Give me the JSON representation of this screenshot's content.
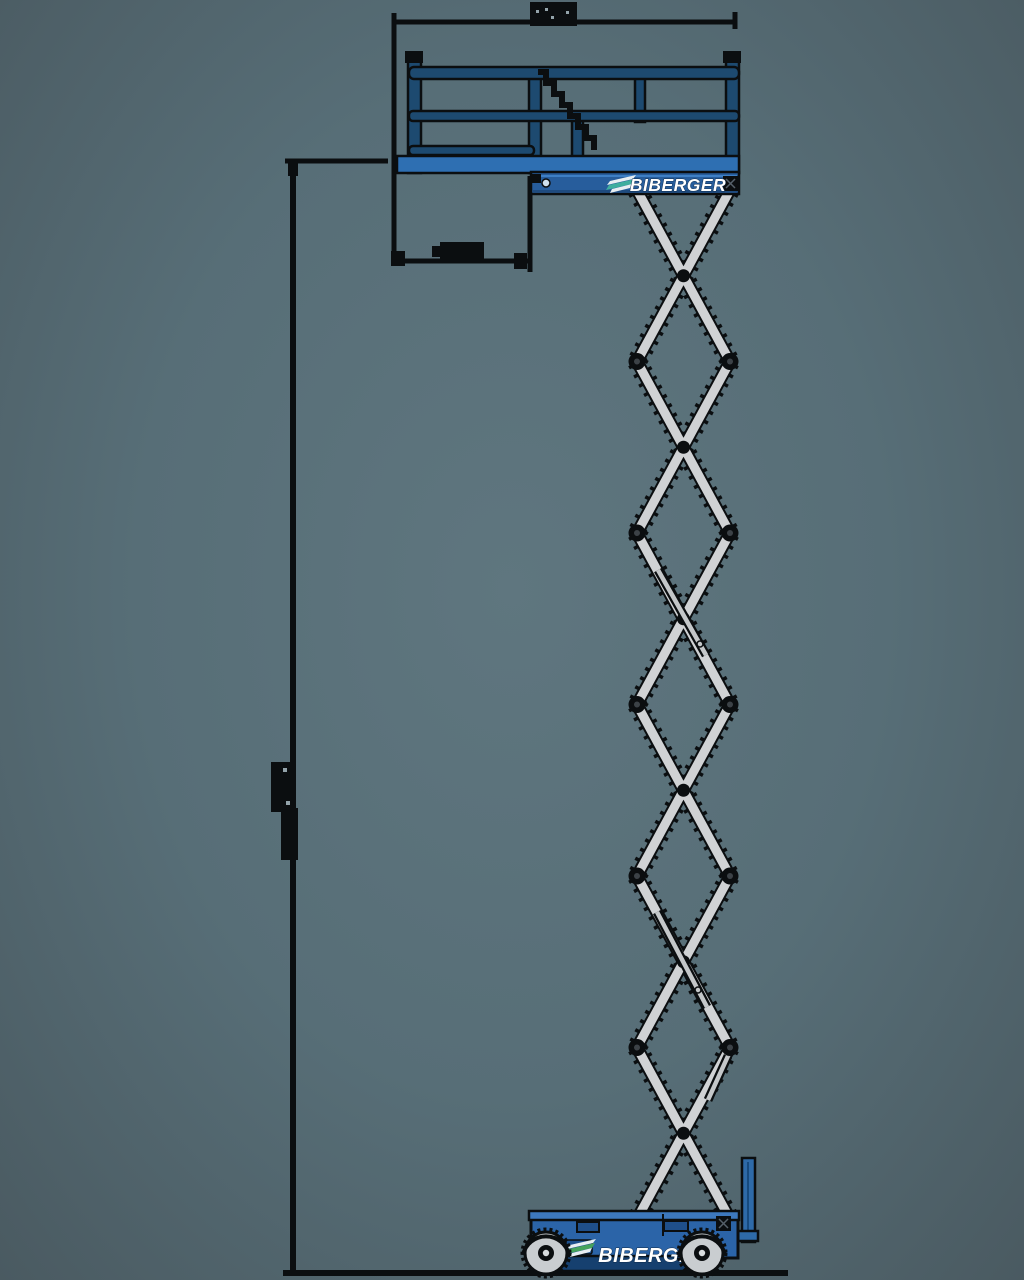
{
  "page": {
    "type": "technical elevation drawing of a scissor lift, fully extended",
    "background_center": "#5f767f",
    "background_edge": "#4a5a61"
  },
  "machine": {
    "brand": "BIBERGER",
    "platform": {
      "logo_text": "BIBERGER",
      "logo_icon": "stripes-flag-icon"
    },
    "chassis": {
      "logo_text": "BIBERGER",
      "logo_icon": "stripes-flag-icon"
    },
    "colors": {
      "rail_blue": "#1d4a70",
      "deck_blue": "#2e6fb2",
      "skirt_blue": "#275d9c",
      "chassis_blue": "#2b64a8",
      "chassis_skirt_blue": "#16406f",
      "ladder_blue": "#2e6aa8",
      "arm_gray": "#d0d2d4",
      "wheel_gray": "#c9cdd0",
      "outline_black": "#0b0e10",
      "logo_accent_teal": "#3fae9e",
      "logo_accent_green": "#46a35c"
    },
    "dimensions": {
      "labels_legible": false,
      "lines": [
        "overall-platform-width (top)",
        "overall-height (left)",
        "footprint-length (below platform)",
        "ground-line (bottom)"
      ]
    }
  }
}
